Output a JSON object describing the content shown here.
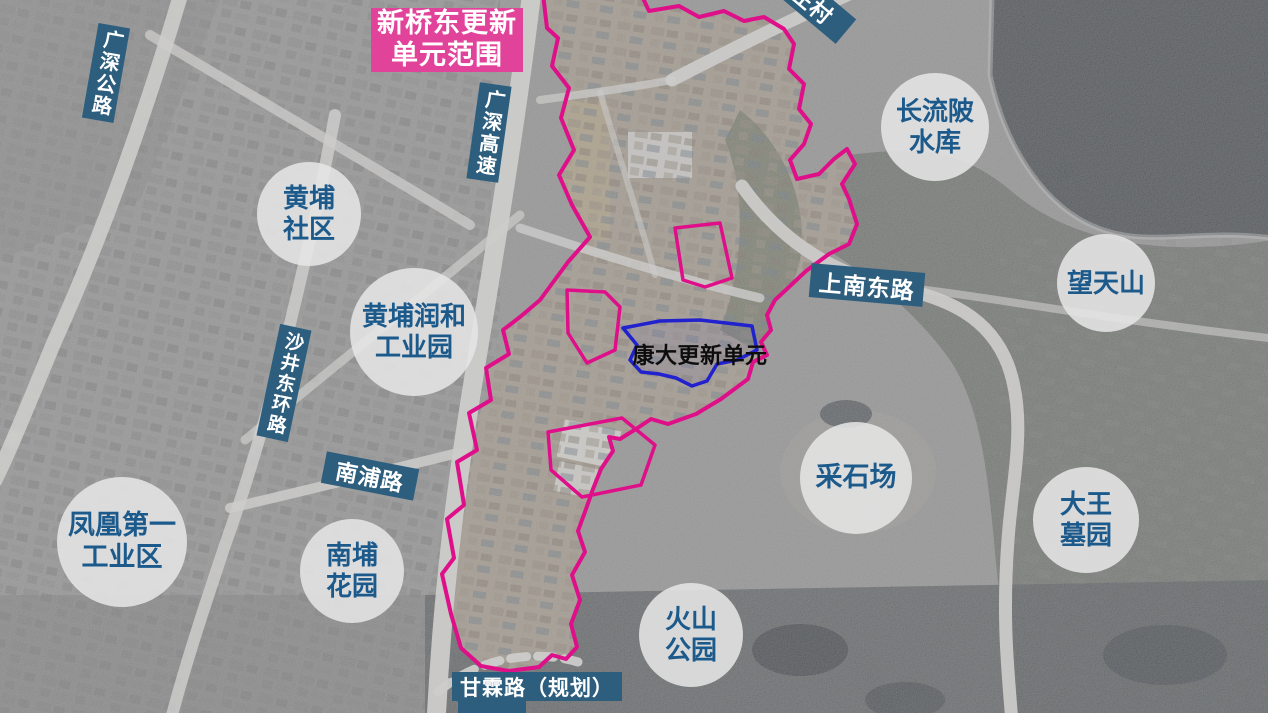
{
  "map": {
    "banner": {
      "text": "新桥东更新\n单元范围"
    },
    "unit_label": {
      "text": "康大更新单元"
    },
    "area_labels": [
      {
        "id": "huangpu-community",
        "text": "黄埔\n社区"
      },
      {
        "id": "huangpu-runhe-industrial-park",
        "text": "黄埔润和\n工业园"
      },
      {
        "id": "fenghuang-first-industrial",
        "text": "凤凰第一\n工业区"
      },
      {
        "id": "nanpu-garden",
        "text": "南埔\n花园"
      },
      {
        "id": "changliupi-reservoir",
        "text": "长流陂\n水库"
      },
      {
        "id": "wangtianshan",
        "text": "望天山"
      },
      {
        "id": "quarry",
        "text": "采石场"
      },
      {
        "id": "dawang-cemetery",
        "text": "大王\n墓园"
      },
      {
        "id": "volcano-park",
        "text": "火山\n公园"
      }
    ],
    "road_labels": [
      {
        "id": "guangshen-highway",
        "text": "广深公路"
      },
      {
        "id": "guangshen-expressway",
        "text": "广深高速"
      },
      {
        "id": "shajing-east-ring",
        "text": "沙井东环路"
      },
      {
        "id": "shangnan-east-road",
        "text": "上南东路"
      },
      {
        "id": "nanpu-road",
        "text": "南浦路"
      },
      {
        "id": "ganlin-road-planned",
        "text": "甘霖路（规划）"
      },
      {
        "id": "zhuangcun-road",
        "text": "庄村"
      }
    ],
    "colors": {
      "boundary_pink": "#df0f8a",
      "banner_pink": "#e2439a",
      "road_label_bg": "#2d5e7e",
      "area_label_text": "#1d5a8c",
      "unit_boundary_blue": "#2121cd"
    }
  }
}
